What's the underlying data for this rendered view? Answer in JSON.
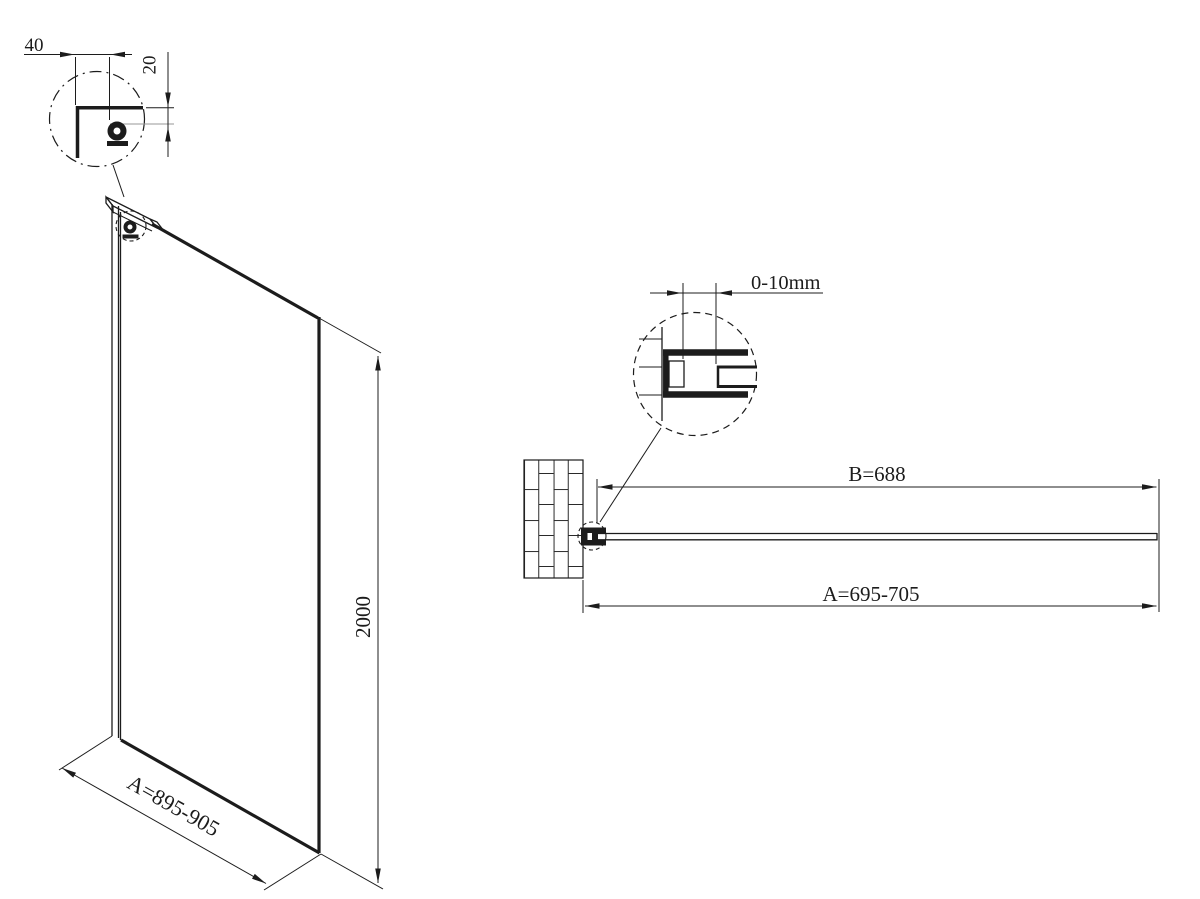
{
  "drawing": {
    "title": "walk-in shower glass panel technical drawing",
    "background": "#ffffff",
    "line_color": "#1c1c1c",
    "front_view": {
      "height_dim": "2000",
      "width_dim": "A=895-905",
      "bracket_detail": {
        "width_dim": "40",
        "height_dim": "20"
      }
    },
    "plan_view": {
      "glass_dim": "B=688",
      "overall_dim": "A=695-705",
      "profile_detail": {
        "adjustment_dim": "0-10mm"
      }
    }
  }
}
